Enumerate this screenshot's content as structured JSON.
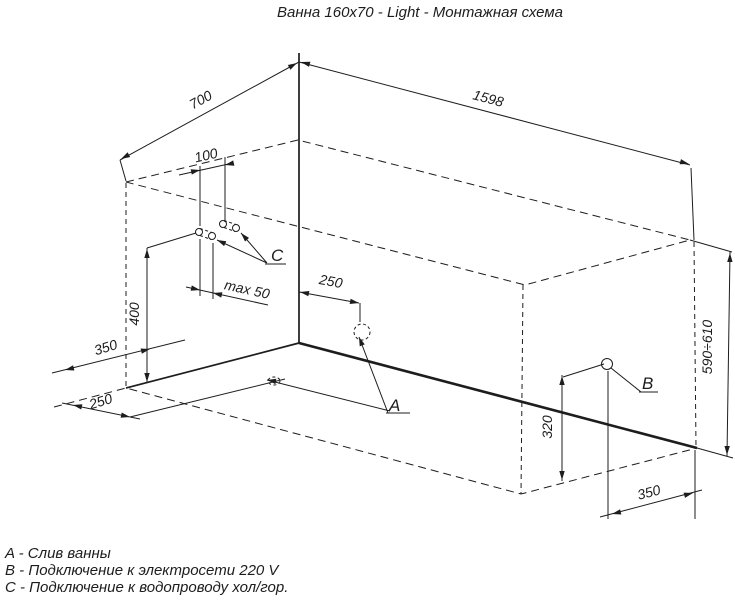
{
  "title": "Ванна 160x70 - Light - Монтажная схема",
  "colors": {
    "ink": "#1d1d1d",
    "background": "#ffffff"
  },
  "dimensions": {
    "tub_width": "700",
    "tub_length": "1598",
    "pipes_spacing": "100",
    "pipes_wall_offset": "max 50",
    "drain_from_wall": "250",
    "pipes_height": "400",
    "floor_depth": "350",
    "floor_drain_depth": "250",
    "outlet_height": "320",
    "outlet_from_corner": "350",
    "rim_height_range": "590÷610"
  },
  "points": {
    "drain": "A",
    "power": "B",
    "water": "C"
  },
  "legend": [
    "A - Слив ванны",
    "B - Подключение к электросети 220 V",
    "C - Подключение к водопроводу хол/гор."
  ]
}
